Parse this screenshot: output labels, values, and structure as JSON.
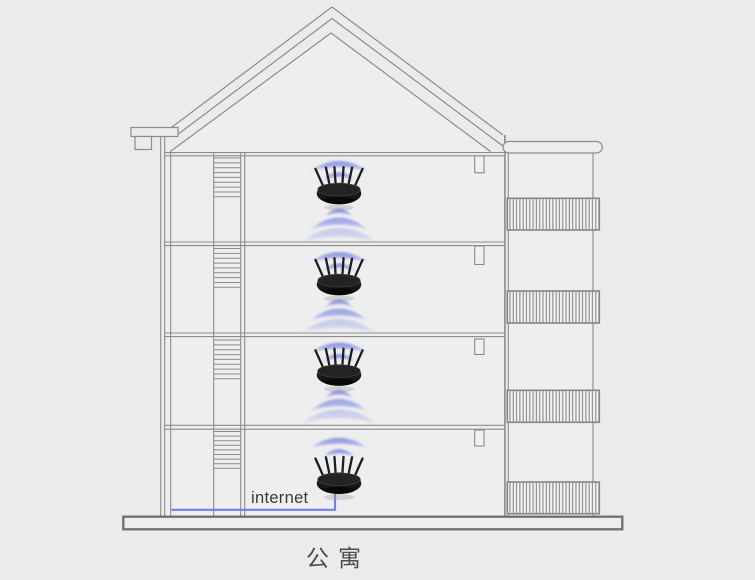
{
  "diagram": {
    "labels": {
      "internet": "internet",
      "caption": "公寓"
    },
    "floor_count": 4,
    "router_count": 4,
    "icons": [
      "router-icon",
      "wifi-waves-icon"
    ],
    "colors": {
      "background": "#ebebeb",
      "outline_gray": "#8c8c8c",
      "platform_gray": "#6f6f6f",
      "cable_blue": "#7280e6",
      "wifi_blue": "#7b87dc",
      "router_black": "#141414"
    }
  }
}
